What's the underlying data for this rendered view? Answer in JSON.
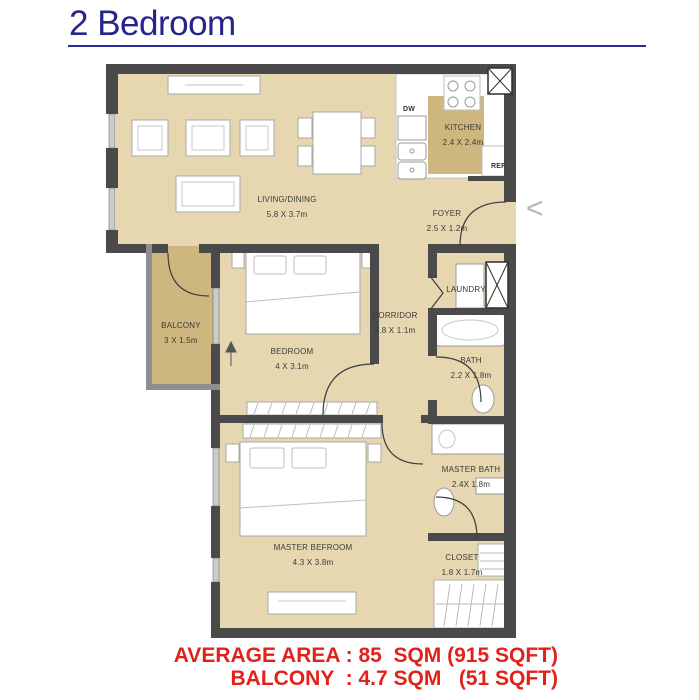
{
  "page": {
    "title": "2 Bedroom",
    "carousel_prev": "<",
    "footer": {
      "line1": "AVERAGE AREA : 85  SQM (915 SQFT)",
      "line2": "BALCONY  : 4.7 SQM   (51 SQFT)"
    }
  },
  "colors": {
    "title_blue": "#24248c",
    "footer_red": "#e3211b",
    "floor_tan": "#e6d7b0",
    "balcony_tan": "#cdb77f",
    "wall_gray": "#4a4a4a"
  },
  "floorplan": {
    "rooms": [
      {
        "name": "LIVING/DINING",
        "dims": "5.8 X 3.7m"
      },
      {
        "name": "KITCHEN",
        "dims": "2.4 X 2.4m"
      },
      {
        "name": "FOYER",
        "dims": "2.5 X 1.2m"
      },
      {
        "name": "BALCONY",
        "dims": "3 X 1.5m"
      },
      {
        "name": "BEDROOM",
        "dims": "4 X 3.1m"
      },
      {
        "name": "CORRIDOR",
        "dims": "3.8 X 1.1m"
      },
      {
        "name": "LAUNDRY",
        "dims": ""
      },
      {
        "name": "BATH",
        "dims": "2.2 X 1.8m"
      },
      {
        "name": "MASTER BATH",
        "dims": "2.4X 1.8m"
      },
      {
        "name": "CLOSET",
        "dims": "1.8 X 1.7m"
      },
      {
        "name": "MASTER BEFROOM",
        "dims": "4.3 X 3.8m"
      }
    ],
    "appliances": {
      "dishwasher": "DW",
      "refrigerator": "REF"
    }
  }
}
